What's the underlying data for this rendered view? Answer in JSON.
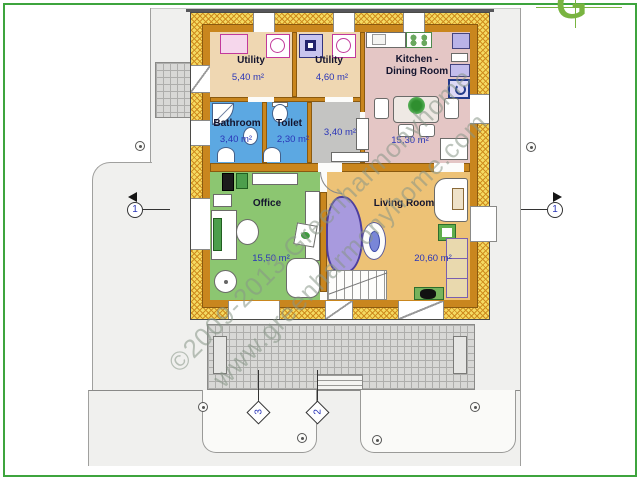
{
  "watermark": {
    "line1": "©2009-2013 Greenharmonyhome",
    "line2": "www.greenharmonyhome.com"
  },
  "logo": {
    "letter": "G",
    "color": "#79b440"
  },
  "rooms": {
    "utility1": {
      "name": "Utility",
      "area": "5,40 m²"
    },
    "utility2": {
      "name": "Utility",
      "area": "4,60 m²"
    },
    "kitchen": {
      "name_line1": "Kitchen -",
      "name_line2": "Dining Room",
      "area": "15,30 m²"
    },
    "bathroom": {
      "name": "Bathroom",
      "area": "3,40 m²"
    },
    "toilet": {
      "name": "Toilet",
      "area": "2,30 m²"
    },
    "hall": {
      "area": "3,40 m²"
    },
    "office": {
      "name": "Office",
      "area": "15,50 m²"
    },
    "living": {
      "name": "Living Room",
      "area": "20,60 m²"
    }
  },
  "markers": {
    "section_left": "1",
    "section_right": "1",
    "bottom_path": "3",
    "bottom_stairs": "2"
  },
  "colors": {
    "frame_green": "#3da43d",
    "wall_orange": "#c9861e",
    "insulation_yellow": "#f4da62",
    "bathroom_blue": "#5ca8e2",
    "office_green": "#8cc671",
    "living_tan": "#edc276",
    "kitchen_pink": "#e4c6c5",
    "utility_tan": "#efd7b2",
    "hall_gray": "#c4c4c2"
  }
}
